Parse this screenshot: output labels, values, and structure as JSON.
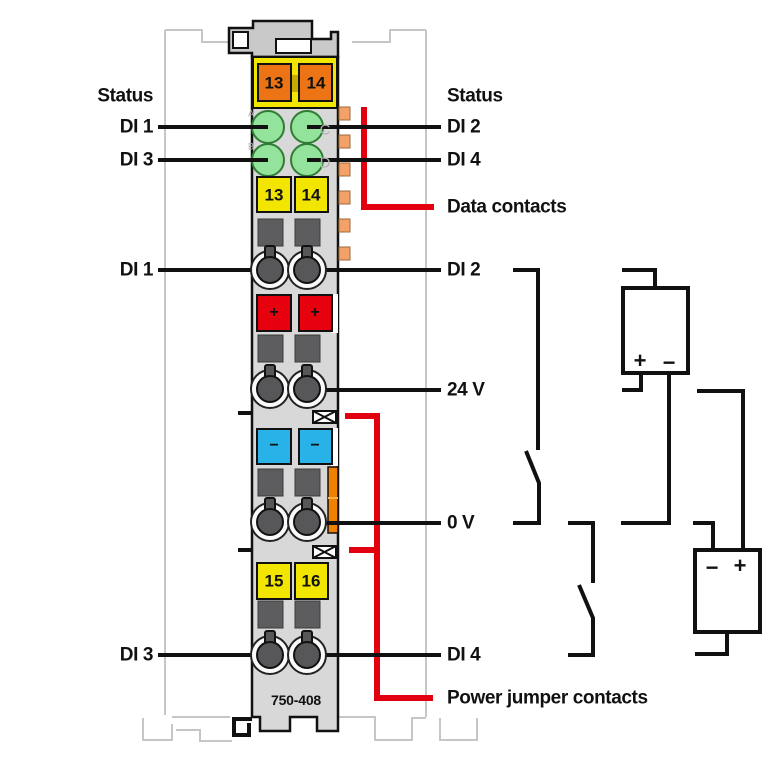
{
  "module": {
    "part_number": "750-408",
    "jumper_contact_terminals": [
      "13",
      "14"
    ],
    "terminal_numbers_upper": [
      "13",
      "14"
    ],
    "terminal_numbers_lower": [
      "15",
      "16"
    ],
    "led_letters": [
      "A",
      "B",
      "C",
      "D"
    ],
    "plus_sign": "+",
    "minus_sign": "−"
  },
  "labels": {
    "left": [
      "Status",
      "DI 1",
      "DI 3",
      "DI 1",
      "DI 3"
    ],
    "right": [
      "Status",
      "DI 2",
      "DI 4",
      "Data contacts",
      "DI 2",
      "24 V",
      "0 V",
      "DI 4",
      "Power jumper contacts"
    ]
  },
  "power_supplies": [
    {
      "plus": "+",
      "minus": "−"
    },
    {
      "minus": "−",
      "plus": "+"
    }
  ],
  "colors": {
    "module_body": "#d8d8d8",
    "latch_gray": "#c9c9c9",
    "terminal_yellow": "#f2e600",
    "terminal_orange": "#ec7414",
    "data_contact_orange": "#f2a269",
    "terminal_red": "#e7000e",
    "terminal_blue": "#29b2e8",
    "led_green": "#94e39c",
    "highlight_red": "#e2000f",
    "wire_black": "#111111",
    "ghost_gray": "#c6c6c6"
  }
}
